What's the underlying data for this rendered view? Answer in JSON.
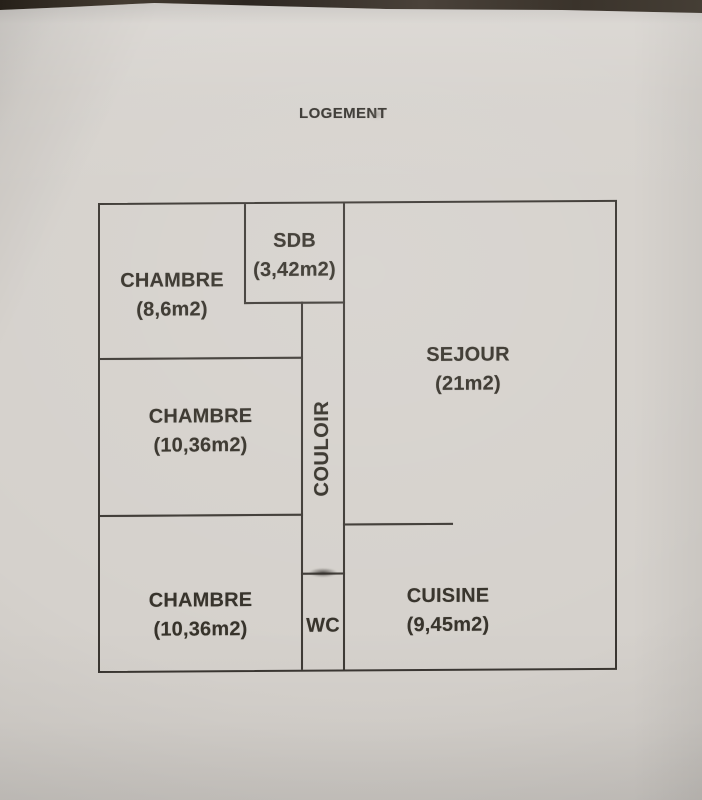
{
  "photo": {
    "background_color": "#3a332b",
    "paper_color": "#d5d1cc",
    "line_color": "#3a3631",
    "text_color": "#353129"
  },
  "title": "LOGEMENT",
  "floor_plan": {
    "rooms": [
      {
        "id": "chambre-1",
        "name": "CHAMBRE",
        "area": "(8,6m2)"
      },
      {
        "id": "sdb",
        "name": "SDB",
        "area": "(3,42m2)"
      },
      {
        "id": "sejour",
        "name": "SEJOUR",
        "area": "(21m2)"
      },
      {
        "id": "chambre-2",
        "name": "CHAMBRE",
        "area": "(10,36m2)"
      },
      {
        "id": "couloir",
        "name": "COULOIR",
        "area": ""
      },
      {
        "id": "chambre-3",
        "name": "CHAMBRE",
        "area": "(10,36m2)"
      },
      {
        "id": "wc",
        "name": "WC",
        "area": ""
      },
      {
        "id": "cuisine",
        "name": "CUISINE",
        "area": "(9,45m2)"
      }
    ]
  }
}
